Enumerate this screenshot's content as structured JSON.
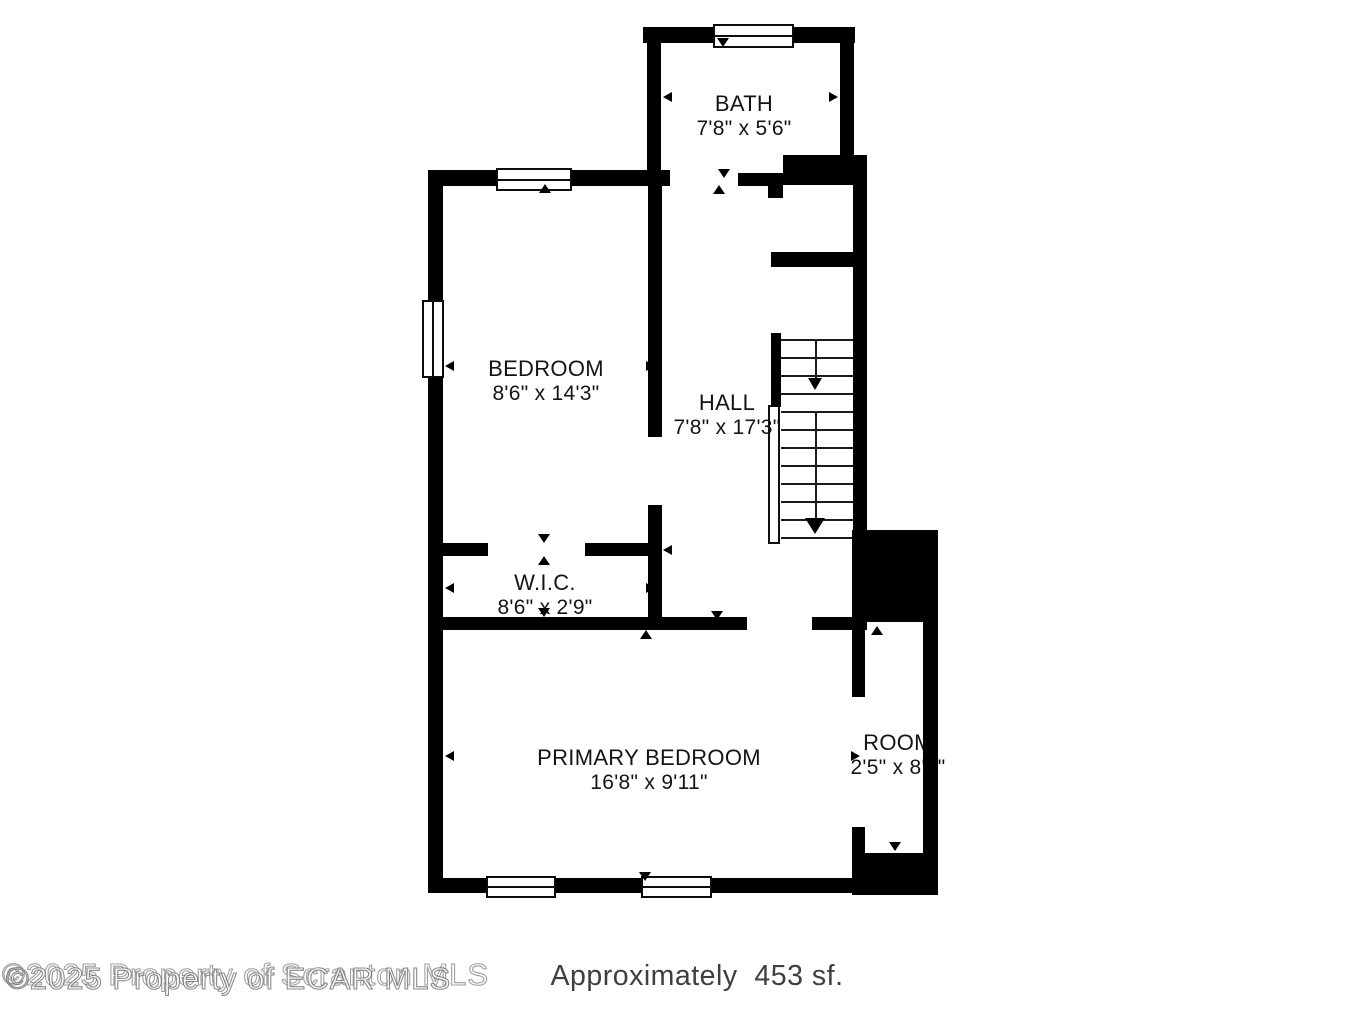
{
  "title": "Floor plan",
  "rooms": {
    "bath": {
      "name": "BATH",
      "dims": "7'8\" x 5'6\""
    },
    "bedroom": {
      "name": "BEDROOM",
      "dims": "8'6\" x 14'3\""
    },
    "hall": {
      "name": "HALL",
      "dims": "7'8\" x 17'3\""
    },
    "wic": {
      "name": "W.I.C.",
      "dims": "8'6\" x 2'9\""
    },
    "primary_bedroom": {
      "name": "PRIMARY BEDROOM",
      "dims": "16'8\" x 9'11\""
    },
    "room": {
      "name": "ROOM",
      "dims": "2'5\" x 8'8\""
    }
  },
  "stairs": {
    "direction_icon": "down-arrow-icon",
    "flights": 2
  },
  "footer": {
    "watermark_base": "©2025 Property of Scranton MLS",
    "watermark_overlay": "©2025 Property of ECAR MLS",
    "area_label": "Approximately  453 sf."
  },
  "colors": {
    "wall": "#000000",
    "background": "#ffffff",
    "label_text": "#141414",
    "footer_text": "#3f3f3f",
    "watermark_outline": "#9a9a9a"
  }
}
